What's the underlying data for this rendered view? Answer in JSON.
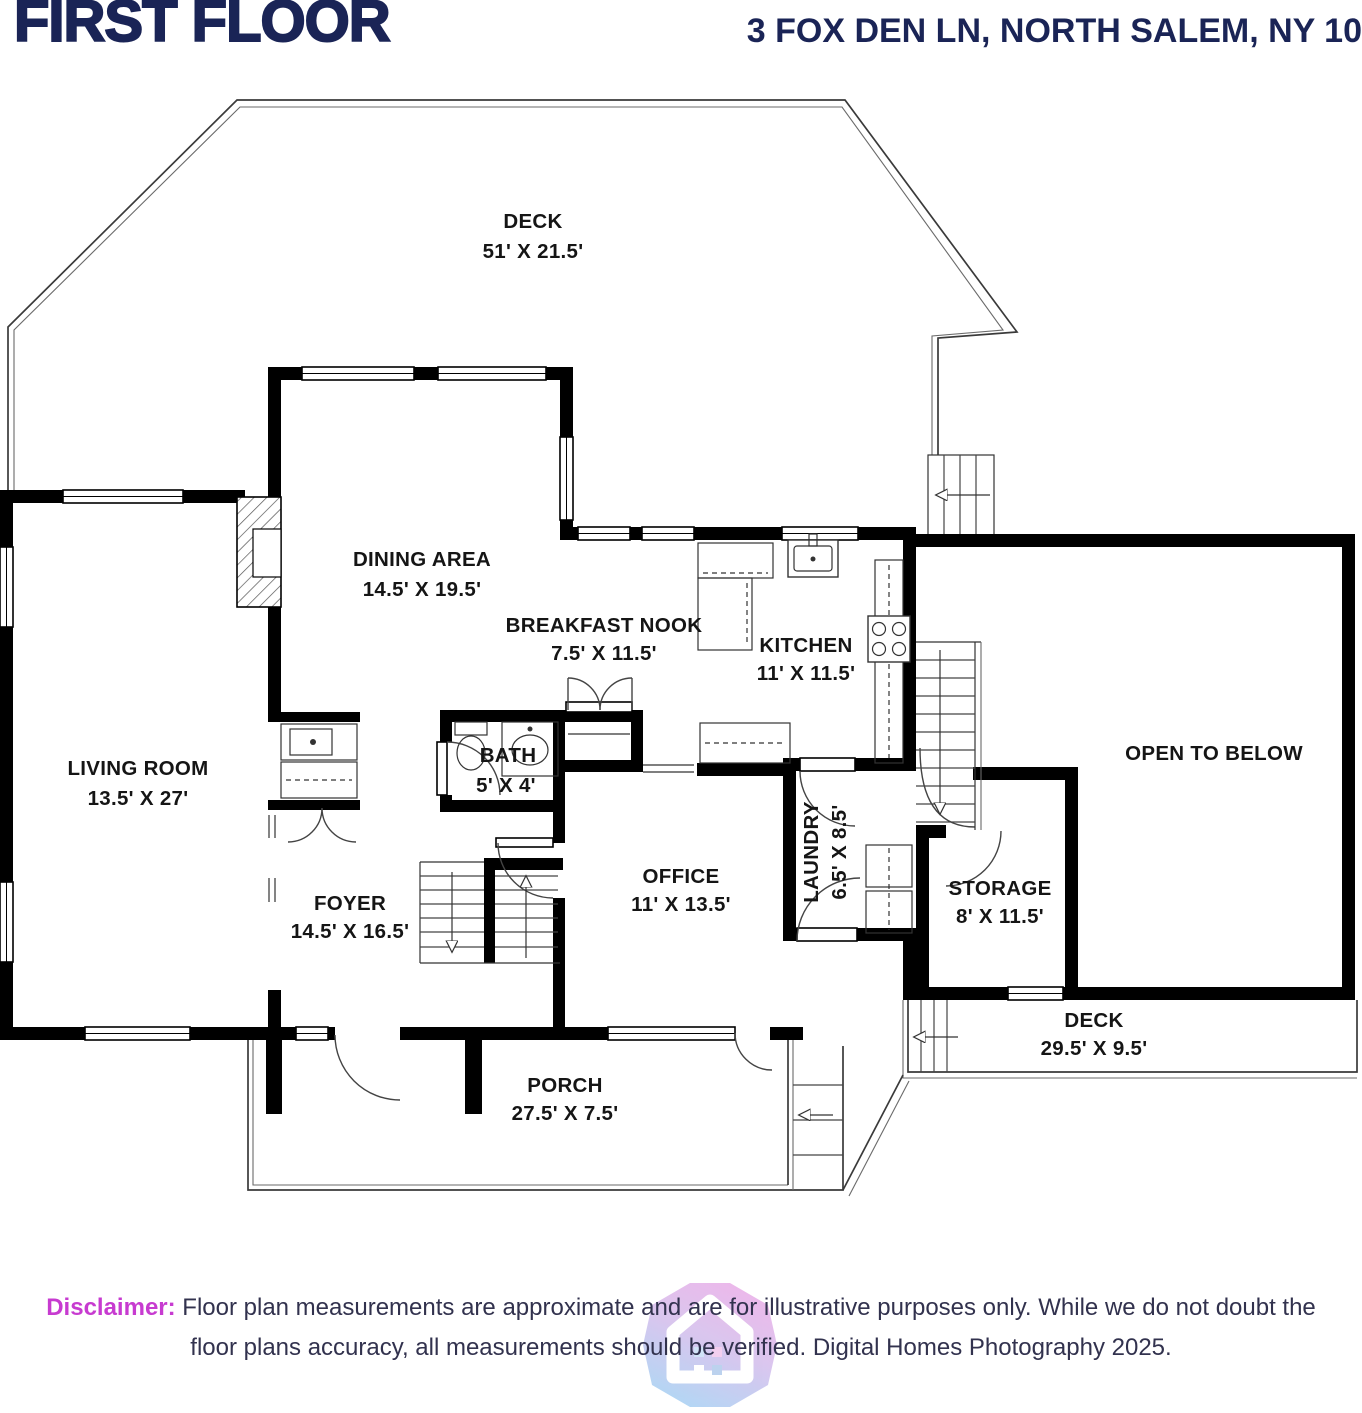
{
  "header": {
    "title": "FIRST FLOOR",
    "address": "3 FOX DEN LN, NORTH SALEM, NY 10"
  },
  "colors": {
    "title_navy": "#1a2456",
    "wall_black": "#000000",
    "disclaimer_magenta": "#c73bd0",
    "disclaimer_text": "#32324e",
    "logo_pink": "#ecb4e9",
    "logo_blue": "#add5f4"
  },
  "rooms": [
    {
      "id": "deck-top",
      "name": "DECK",
      "dims": "51' X 21.5'"
    },
    {
      "id": "dining-area",
      "name": "DINING AREA",
      "dims": "14.5' X 19.5'"
    },
    {
      "id": "breakfast-nook",
      "name": "BREAKFAST NOOK",
      "dims": "7.5' X 11.5'"
    },
    {
      "id": "kitchen",
      "name": "KITCHEN",
      "dims": "11' X 11.5'"
    },
    {
      "id": "living-room",
      "name": "LIVING ROOM",
      "dims": "13.5' X 27'"
    },
    {
      "id": "bath",
      "name": "BATH",
      "dims": "5' X 4'"
    },
    {
      "id": "open-to-below",
      "name": "OPEN TO BELOW",
      "dims": ""
    },
    {
      "id": "foyer",
      "name": "FOYER",
      "dims": "14.5' X 16.5'"
    },
    {
      "id": "office",
      "name": "OFFICE",
      "dims": "11' X 13.5'"
    },
    {
      "id": "laundry",
      "name": "LAUNDRY",
      "dims": "6.5' X 8.5'"
    },
    {
      "id": "storage",
      "name": "STORAGE",
      "dims": "8' X 11.5'"
    },
    {
      "id": "deck-rear",
      "name": "DECK",
      "dims": "29.5' X 9.5'"
    },
    {
      "id": "porch",
      "name": "PORCH",
      "dims": "27.5' X 7.5'"
    }
  ],
  "fixtures": [
    "chimney-hatch",
    "stairs-up",
    "stairs-down",
    "deck-stairs",
    "rear-deck-steps",
    "porch-steps",
    "kitchen-sink",
    "kitchen-stove",
    "kitchen-counter",
    "island-counter",
    "bath-toilet",
    "bath-sink",
    "washer-dryer",
    "wet-bar-sink",
    "entry-door",
    "interior-door",
    "closet-double-doors",
    "window"
  ],
  "disclaimer": {
    "label": "Disclaimer:",
    "line1": " Floor plan measurements are approximate and are for illustrative purposes only. While we do not doubt the",
    "line2": "floor plans accuracy, all measurements should be verified. Digital Homes Photography 2025."
  },
  "logo": {
    "name": "digital-homes-photography-logo"
  }
}
